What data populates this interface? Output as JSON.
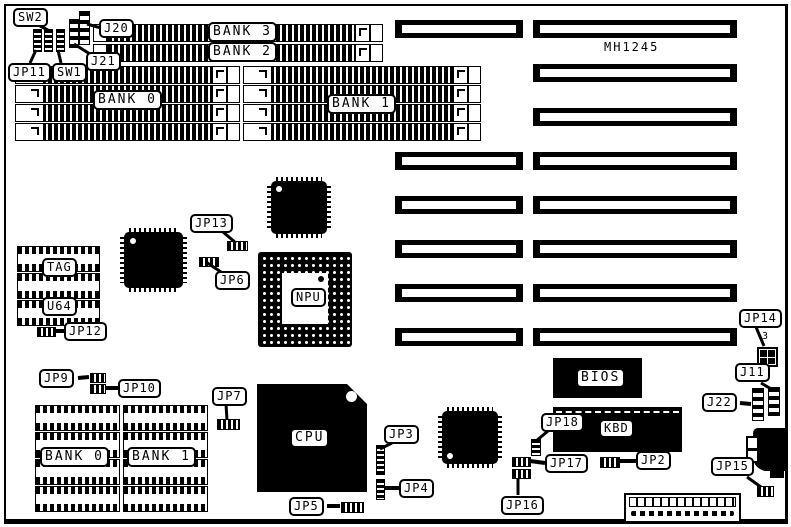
{
  "board": {
    "model": "MH1245",
    "jp14_pin_label": "3"
  },
  "memory": {
    "simm_bank3": "BANK 3",
    "simm_bank2": "BANK 2",
    "simm_bank0": "BANK 0",
    "simm_bank1": "BANK 1",
    "dram_bank0": "BANK 0",
    "dram_bank1": "BANK 1",
    "cache_tag": "TAG",
    "cache_u64": "U64"
  },
  "chips": {
    "cpu": "CPU",
    "npu": "NPU",
    "bios": "BIOS",
    "kbd": "KBD"
  },
  "switches": {
    "sw1": "SW1",
    "sw2": "SW2"
  },
  "connectors": {
    "j11": "J11",
    "j20": "J20",
    "j21": "J21",
    "j22": "J22"
  },
  "jumpers": {
    "jp2": "JP2",
    "jp3": "JP3",
    "jp4": "JP4",
    "jp5": "JP5",
    "jp6": "JP6",
    "jp7": "JP7",
    "jp9": "JP9",
    "jp10": "JP10",
    "jp11": "JP11",
    "jp12": "JP12",
    "jp13": "JP13",
    "jp14": "JP14",
    "jp15": "JP15",
    "jp16": "JP16",
    "jp17": "JP17",
    "jp18": "JP18"
  }
}
